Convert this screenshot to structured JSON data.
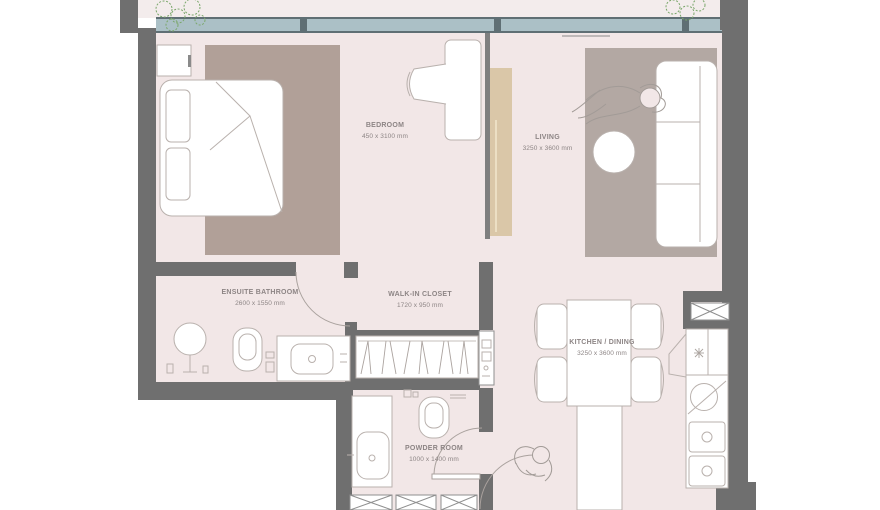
{
  "plan": {
    "type": "apartment-floor-plan",
    "rooms": [
      {
        "name": "BEDROOM",
        "dims": "450 x 3100 mm"
      },
      {
        "name": "LIVING",
        "dims": "3250 x 3600 mm"
      },
      {
        "name": "ENSUITE BATHROOM",
        "dims": "2600 x 1550 mm"
      },
      {
        "name": "WALK-IN CLOSET",
        "dims": "1720 x 950 mm"
      },
      {
        "name": "KITCHEN / DINING",
        "dims": "3250 x 3600 mm"
      },
      {
        "name": "POWDER ROOM",
        "dims": "1000 x 1400 mm"
      }
    ],
    "colors": {
      "wall": "#6f6f6f",
      "floor": "#f2e7e7",
      "balcony_floor": "#f3ecec",
      "bedroom_carpet": "#b1a098",
      "living_rug": "#b3a8a3",
      "console": "#dac7a8",
      "window_glass": "#abc0c6",
      "window_frame": "#5f6f74",
      "furniture_stroke": "#b9b1ad",
      "label_text": "#8d8585",
      "plant_green": "#7aa76a"
    },
    "icons": [
      "plant-icon",
      "bed",
      "pillow",
      "dresser",
      "desk",
      "desk-chair",
      "tv-console",
      "sofa",
      "round-table",
      "rug",
      "person-figure",
      "shower-basin",
      "toilet",
      "vanity-sink",
      "wardrobe-hangers",
      "utility-panel",
      "kitchen-counter",
      "kitchen-sink",
      "cooktop",
      "dining-table",
      "dining-chair",
      "kitchen-island",
      "powder-sink",
      "door-arc",
      "duct-shaft"
    ]
  }
}
